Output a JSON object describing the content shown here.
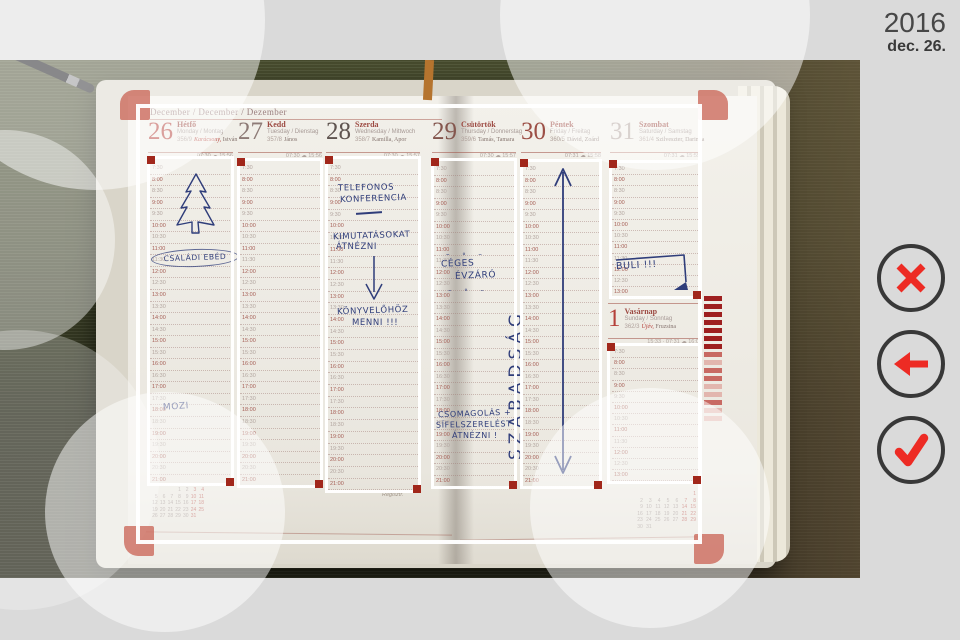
{
  "panel": {
    "year": "2016",
    "date": "dec. 26."
  },
  "colors": {
    "accent_red": "#ed2b24",
    "handle_red": "#a1271b",
    "frame_white": "#ffffff",
    "ink_blue": "#2f3d7a",
    "background_gray": "#dadada"
  },
  "planner": {
    "month_header": "December / December / Dezember",
    "days": [
      {
        "num": "26",
        "name": "Hétfő",
        "intl": "Monday / Montag",
        "ord": "356/9",
        "nameday_red": "Karácsony,",
        "nameday": " István",
        "meta": "07:30 ☁ 15:56"
      },
      {
        "num": "27",
        "name": "Kedd",
        "intl": "Tuesday / Dienstag",
        "ord": "357/8",
        "nameday_red": "",
        "nameday": "János",
        "meta": "07:30 ☁ 15:56"
      },
      {
        "num": "28",
        "name": "Szerda",
        "intl": "Wednesday / Mittwoch",
        "ord": "358/7",
        "nameday_red": "",
        "nameday": "Kamilla, Apor",
        "meta": "07:30 ☁ 15:57"
      },
      {
        "num": "29",
        "name": "Csütörtök",
        "intl": "Thursday / Donnerstag",
        "ord": "359/6",
        "nameday_red": "",
        "nameday": "Tamás, Tamara",
        "meta": "07:30 ☁ 15:57"
      },
      {
        "num": "30",
        "name": "Péntek",
        "intl": "Friday / Freitag",
        "ord": "360/5",
        "nameday_red": "",
        "nameday": "Dávid, Zoárd",
        "meta": "07:31 ☁ 15:58"
      },
      {
        "num": "31",
        "name": "Szombat",
        "intl": "Saturday / Samstag",
        "ord": "361/4",
        "nameday_red": "",
        "nameday": "Szilveszter, Darinka",
        "meta": "07:31 ☁ 15:59"
      }
    ],
    "sunday": {
      "num": "1",
      "name": "Vasárnap",
      "intl": "Sunday / Sonntag",
      "ord": "362/3",
      "nameday_red": "Újév,",
      "nameday": " Fruzsina",
      "meta": "15:33 · 07:31 ☁ 16:00"
    },
    "times": [
      "7:30",
      "8:00",
      "8:30",
      "9:00",
      "9:30",
      "10:00",
      "10:30",
      "11:00",
      "11:30",
      "12:00",
      "12:30",
      "13:00",
      "13:30",
      "14:00",
      "14:30",
      "15:00",
      "15:30",
      "16:00",
      "16:30",
      "17:00",
      "17:30",
      "18:00",
      "18:30",
      "19:00",
      "19:30",
      "20:00",
      "20:30",
      "21:00"
    ],
    "notes": {
      "mon_lunch": "CSALÁDI EBÉD",
      "mon_movie": "MOZI",
      "wed1": "TELEFONOS",
      "wed2": "KONFERENCIA",
      "wed3": "KIMUTATÁSOKAT",
      "wed4": "ÁTNÉZNI",
      "wed5": "KÖNYVELŐHÖZ",
      "wed6": "MENNI !!!",
      "thu1": "CÉGES",
      "thu2": "ÉVZÁRÓ",
      "thu_deco": "–  ∘  –",
      "thu3": "CSOMAGOLÁS +",
      "thu4": "SÍFELSZERELÉST",
      "thu5": "ÁTNÉZNI !",
      "fri": "SZABADSÁG",
      "sat": "BULI !!!"
    },
    "footer_left": "Regisztr.",
    "calendars": {
      "december": [
        [
          "",
          "",
          "",
          "1",
          "2",
          "3",
          "4"
        ],
        [
          "5",
          "6",
          "7",
          "8",
          "9",
          "10",
          "11"
        ],
        [
          "12",
          "13",
          "14",
          "15",
          "16",
          "17",
          "18"
        ],
        [
          "19",
          "20",
          "21",
          "22",
          "23",
          "24",
          "25"
        ],
        [
          "26",
          "27",
          "28",
          "29",
          "30",
          "31",
          ""
        ]
      ],
      "january": [
        [
          "",
          "",
          "",
          "",
          "",
          "",
          "1"
        ],
        [
          "2",
          "3",
          "4",
          "5",
          "6",
          "7",
          "8"
        ],
        [
          "9",
          "10",
          "11",
          "12",
          "13",
          "14",
          "15"
        ],
        [
          "16",
          "17",
          "18",
          "19",
          "20",
          "21",
          "22"
        ],
        [
          "23",
          "24",
          "25",
          "26",
          "27",
          "28",
          "29"
        ],
        [
          "30",
          "31",
          "",
          "",
          "",
          "",
          ""
        ]
      ]
    },
    "edge_tabs": [
      "dark",
      "dark",
      "dark",
      "dark",
      "dark",
      "dark",
      "dark",
      "mid",
      "light",
      "mid",
      "mid",
      "light",
      "light",
      "mid",
      "light",
      "light"
    ]
  }
}
